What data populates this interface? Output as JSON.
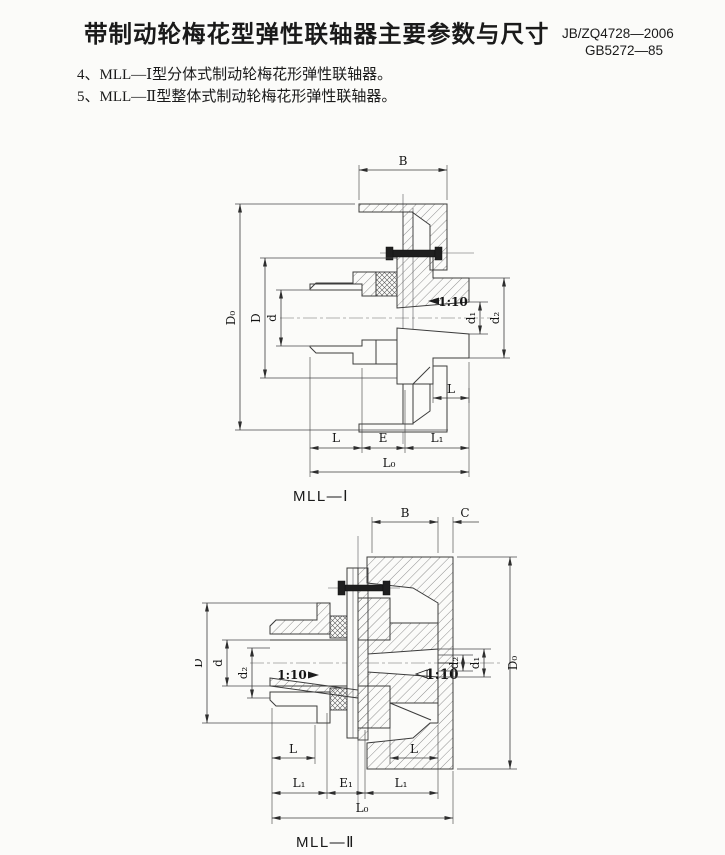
{
  "header": {
    "title": "带制动轮梅花型弹性联轴器主要参数与尺寸",
    "standard_1": "JB/ZQ4728—2006",
    "standard_2": "GB5272—85"
  },
  "notes": {
    "item_4": "4、MLL—Ⅰ型分体式制动轮梅花形弹性联轴器。",
    "item_5": "5、MLL—Ⅱ型整体式制动轮梅花形弹性联轴器。"
  },
  "diagram_mll1": {
    "caption": "MLL—Ⅰ",
    "dims": {
      "B": "B",
      "D0": "D₀",
      "D": "D",
      "d": "d",
      "taper": "1:10",
      "d1": "d₁",
      "d2": "d₂",
      "L_hub": "L",
      "L_left": "L",
      "E": "E",
      "L1": "L₁",
      "L0": "L₀"
    }
  },
  "diagram_mll2": {
    "caption": "MLL—Ⅱ",
    "dims": {
      "B": "B",
      "C": "C",
      "D": "D",
      "d": "d",
      "d2_left": "d₂",
      "taper_left": "1:10",
      "taper_right": "1:10",
      "d2_right": "d₂",
      "d1": "d₁",
      "D0": "D₀",
      "L_left": "L",
      "L_right": "L",
      "L1_left": "L₁",
      "E1": "E₁",
      "L1_right": "L₁",
      "L0": "L₀"
    }
  },
  "colors": {
    "line": "#3c3c3c",
    "background": "#fbfbf9",
    "ink": "#1a1a1a"
  }
}
